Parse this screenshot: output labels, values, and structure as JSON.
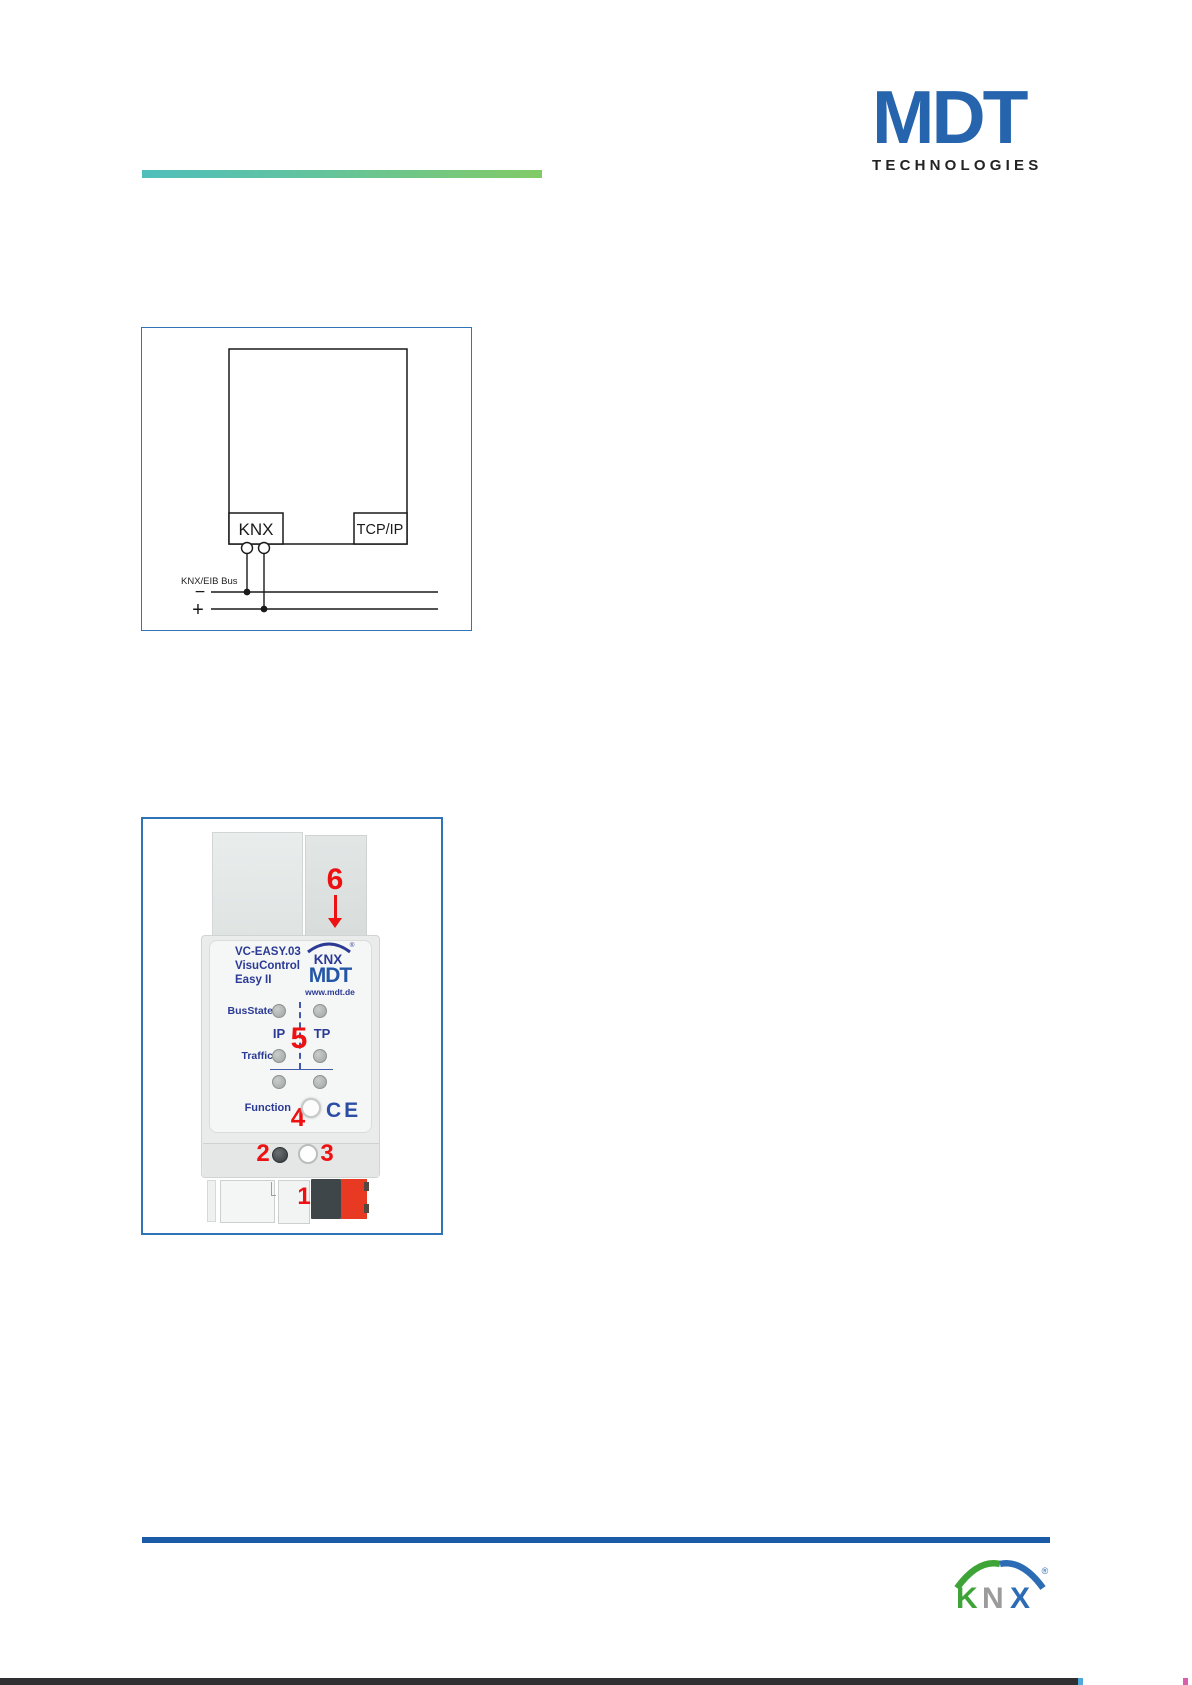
{
  "header": {
    "logo_text": "MDT",
    "logo_subtext": "TECHNOLOGIES"
  },
  "figure_connection": {
    "knx_port_label": "KNX",
    "tcpip_port_label": "TCP/IP",
    "bus_label": "KNX/EIB Bus",
    "minus_label": "−",
    "plus_label": "+"
  },
  "figure_device": {
    "callouts": {
      "one": "1",
      "two": "2",
      "three": "3",
      "four": "4",
      "five": "5",
      "six": "6"
    },
    "model": "VC-EASY.03",
    "product_line1": "VisuControl",
    "product_line2": "Easy II",
    "knx_badge": "KNX",
    "knx_badge_registered": "®",
    "mdt_badge": "MDT",
    "website": "www.mdt.de",
    "led_label_busstate": "BusState",
    "column_ip": "IP",
    "column_tp": "TP",
    "led_label_traffic": "Traffic",
    "function_label": "Function",
    "ce_mark": "CE"
  },
  "footer": {
    "knx_k": "K",
    "knx_n": "N",
    "knx_x": "X",
    "registered": "®"
  },
  "colors": {
    "mdt_blue": "#2764ae",
    "figure_border": "#2e74b6",
    "footer_line_blue": "#1b5aa7",
    "annotation_red": "#ee1111",
    "device_text_blue": "#2b3a94",
    "gradient_start": "#4fbfbc",
    "gradient_end": "#82ca66",
    "knx_logo_green": "#3fa437",
    "knx_logo_gray": "#9b9b9b",
    "knx_logo_blue": "#2b6cb5",
    "terminal_dark": "#3f4649",
    "terminal_red": "#e83a22"
  }
}
